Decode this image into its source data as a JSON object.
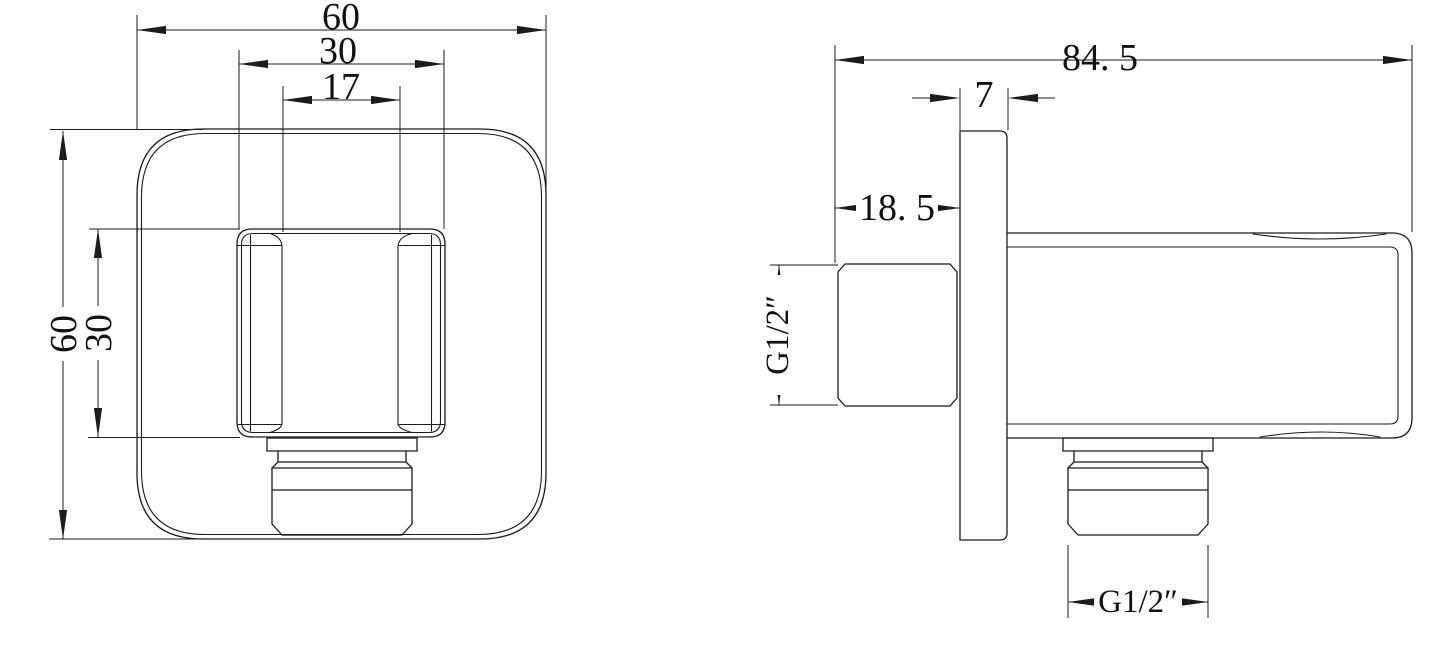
{
  "drawing": {
    "type": "technical-dimension-drawing",
    "colors": {
      "ink": "#1b1b1b",
      "background": "#ffffff"
    },
    "front_view": {
      "dims": {
        "width_outer": "60",
        "width_mid": "30",
        "width_inner": "17",
        "height_outer": "60",
        "height_mid": "30"
      }
    },
    "side_view": {
      "dims": {
        "length_overall": "84. 5",
        "plate_thickness": "7",
        "inlet_offset": "18. 5",
        "inlet_thread": "G1/2″",
        "outlet_thread": "G1/2″"
      }
    }
  }
}
